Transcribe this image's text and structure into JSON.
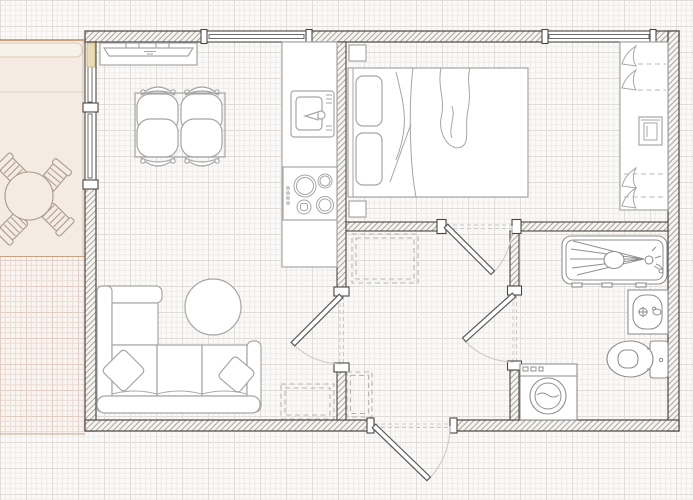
{
  "canvas": {
    "width": 693,
    "height": 500
  },
  "colors": {
    "grid-bg": "#fbfaf8",
    "grid-minor": "#efedea",
    "grid-major": "#e0ddd9",
    "wall-border": "#4a4845",
    "wall-hatch-line": "#a9a39c",
    "glass-line": "#6b6b6b",
    "furniture": "#a6a6a6",
    "fixture": "#8f8f8f",
    "door-leaf": "#5a5a5a",
    "door-arc": "#cbcbcb",
    "dashed-item": "#b5b5b5",
    "patio-fill": "#f4ebe2",
    "patio-band": "#f8f1e9",
    "patio-line": "#b9895f",
    "patio-grid-bg": "#faf5f1",
    "patio-grid-line": "#eadcd5",
    "patio-furniture": "#a89a88",
    "balcony-door": "#e9dcb2"
  },
  "floor_plan": {
    "rooms": [
      {
        "name": "kitchen-dining"
      },
      {
        "name": "living-area"
      },
      {
        "name": "bedroom"
      },
      {
        "name": "bathroom"
      },
      {
        "name": "hallway"
      },
      {
        "name": "patio"
      }
    ],
    "furniture": [
      {
        "item": "patio-round-table",
        "room": "patio"
      },
      {
        "item": "patio-chair",
        "room": "patio",
        "count": 4
      },
      {
        "item": "tv-console",
        "room": "kitchen-dining"
      },
      {
        "item": "dining-table",
        "room": "kitchen-dining"
      },
      {
        "item": "dining-chair",
        "room": "kitchen-dining",
        "count": 4
      },
      {
        "item": "kitchen-counter",
        "room": "kitchen-dining"
      },
      {
        "item": "kitchen-sink",
        "room": "kitchen-dining"
      },
      {
        "item": "cooktop-4-burners",
        "room": "kitchen-dining"
      },
      {
        "item": "corner-sofa",
        "room": "living-area"
      },
      {
        "item": "throw-pillow",
        "room": "living-area",
        "count": 2
      },
      {
        "item": "round-coffee-table",
        "room": "living-area"
      },
      {
        "item": "double-bed",
        "room": "bedroom"
      },
      {
        "item": "pillow",
        "room": "bedroom",
        "count": 2
      },
      {
        "item": "nightstand",
        "room": "bedroom",
        "count": 2
      },
      {
        "item": "wardrobe",
        "room": "bedroom"
      },
      {
        "item": "bathtub-shower",
        "room": "bathroom"
      },
      {
        "item": "washbasin",
        "room": "bathroom"
      },
      {
        "item": "toilet",
        "room": "bathroom"
      },
      {
        "item": "washing-machine",
        "room": "bathroom"
      },
      {
        "item": "dashed-placeholder",
        "room": "hallway",
        "count": 2
      },
      {
        "item": "dashed-placeholder",
        "room": "living-area",
        "count": 1
      }
    ],
    "doors": [
      {
        "name": "entrance-door",
        "wall": "bottom",
        "swing": "outward"
      },
      {
        "name": "living-room-door",
        "wall": "interior-left",
        "swing": "into-living"
      },
      {
        "name": "bedroom-door",
        "wall": "interior-top",
        "swing": "into-hall"
      },
      {
        "name": "bathroom-door",
        "wall": "interior-right",
        "swing": "into-hall"
      },
      {
        "name": "balcony-door",
        "wall": "left",
        "swing": "open"
      }
    ],
    "windows": [
      {
        "name": "kitchen-window",
        "wall": "top"
      },
      {
        "name": "bedroom-window",
        "wall": "top"
      },
      {
        "name": "living-window",
        "wall": "left"
      }
    ]
  }
}
